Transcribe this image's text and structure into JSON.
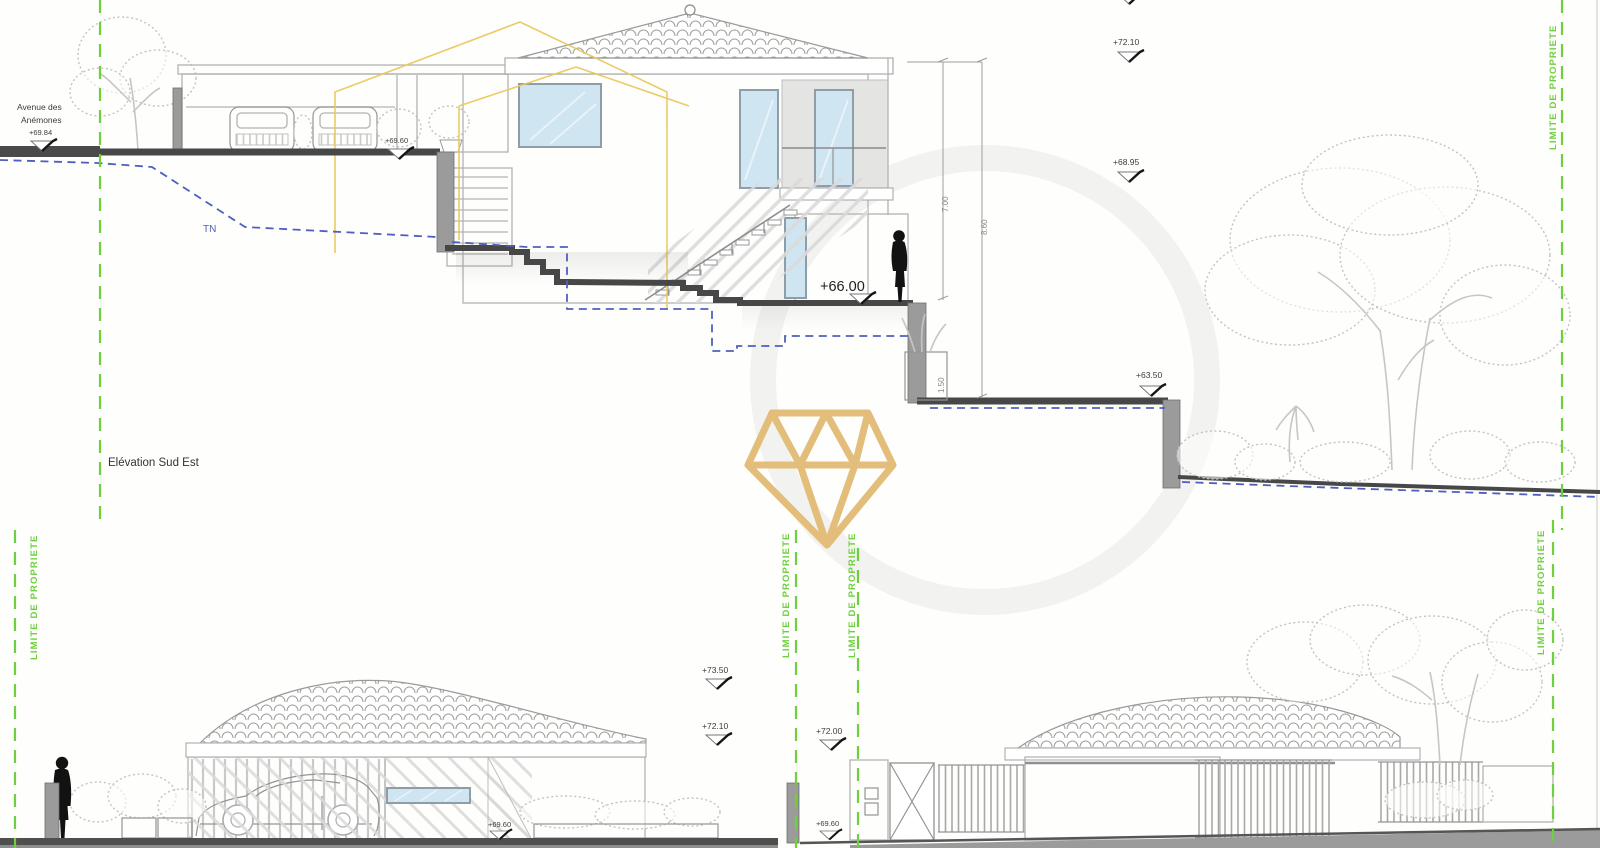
{
  "drawing": {
    "title": "Elévation Sud Est",
    "street_name_1": "Avenue des",
    "street_name_2": "Anémones",
    "street_level": "+69.84",
    "terrain_label": "TN",
    "property_limit": "LIMITE DE PROPRIETE",
    "levels": {
      "roof_parapet": "+72.10",
      "floor_mid": "+68.95",
      "garage_street": "+69.60",
      "terrace_main": "+66.00",
      "garden_lower": "+63.50"
    },
    "dims": {
      "terrace_height": "7.00",
      "garden_height": "8.60",
      "planter_depth": "1.50"
    },
    "bottom_left_elevation": {
      "ridge": "+73.50",
      "eave": "+72.10",
      "street": "+69.60"
    },
    "bottom_right_elevation": {
      "eave": "+72.00",
      "street": "+69.60"
    },
    "colors": {
      "limit_green": "#6fcf3f",
      "terrain_blue": "#4e5fc0",
      "logo_gold": "#e3bd7a",
      "overlay_yellow": "#eac95f"
    }
  }
}
